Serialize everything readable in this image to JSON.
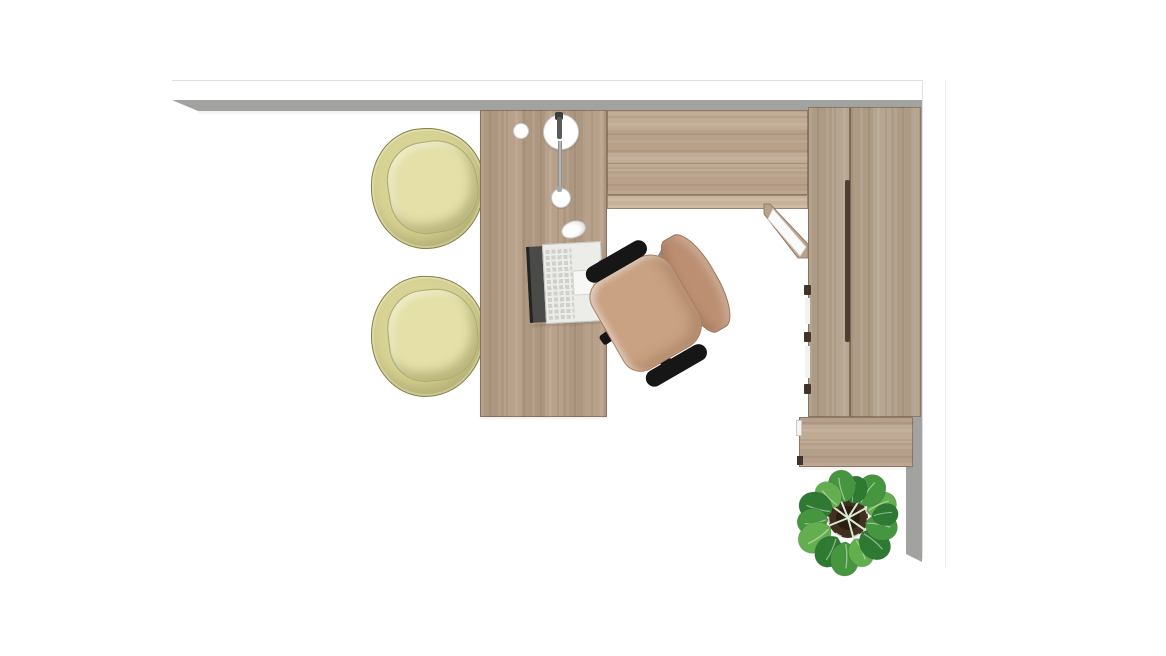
{
  "scene": {
    "title": "Office interior plan — top view render",
    "objects": [
      {
        "id": "wall-top",
        "label": "Wall segment (top)"
      },
      {
        "id": "wall-right",
        "label": "Wall segment (right)"
      },
      {
        "id": "desk",
        "label": "Reception desk (wood)"
      },
      {
        "id": "desk-return",
        "label": "Desk return work surface"
      },
      {
        "id": "desk-end-panel",
        "label": "Desk end support panel"
      },
      {
        "id": "wardrobe",
        "label": "Tall two-door storage cabinet"
      },
      {
        "id": "credenza",
        "label": "Low cabinet"
      },
      {
        "id": "guest-chair-1",
        "label": "Guest tub chair"
      },
      {
        "id": "guest-chair-2",
        "label": "Guest tub chair"
      },
      {
        "id": "task-chair",
        "label": "Office task chair"
      },
      {
        "id": "laptop",
        "label": "Open laptop"
      },
      {
        "id": "mouse",
        "label": "Computer mouse"
      },
      {
        "id": "desk-lamp",
        "label": "Desk lamp"
      },
      {
        "id": "grommet",
        "label": "Cable grommet"
      },
      {
        "id": "plant",
        "label": "Potted plant"
      }
    ],
    "palette": {
      "wall-white": "#ffffff",
      "wall-shadow": "#a2a2a0",
      "wood-base": "#b49c85",
      "wood-light": "#bda68e",
      "wood-edge": "#c6b199",
      "wood-cab": "#b2a08b",
      "wood-low": "#bba58f",
      "guest-rim": "#d7d394",
      "guest-seat": "#e4e0a8",
      "guest-outline": "#85813f",
      "chair-seat": "#c9a183",
      "chair-back": "#bc8f72",
      "armrest": "#161616",
      "metal": "#8d8d8d",
      "laptop-deck": "#ecece9",
      "key": "#cfcfcc",
      "lamp-gray": "#b5b5b3",
      "leaf-dark": "#2e7a33",
      "leaf-mid": "#46953f",
      "leaf-light": "#63ae4e",
      "pot": "#41301f",
      "pot-inner": "#2a1e13",
      "stem": "#dde8d4"
    }
  }
}
